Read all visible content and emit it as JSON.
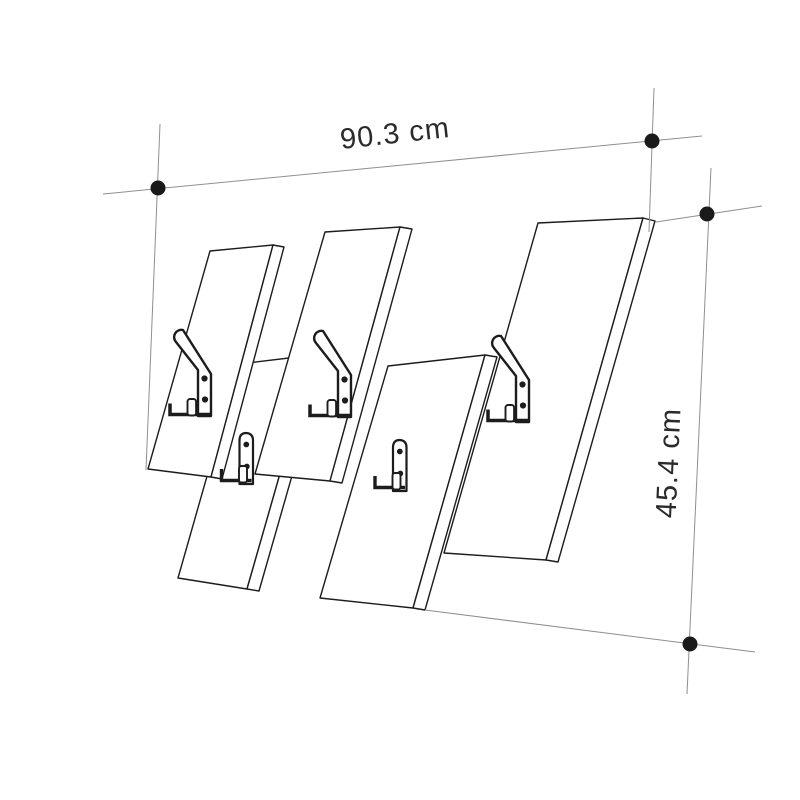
{
  "diagram": {
    "kind": "furniture-dimension-drawing",
    "subject": "wall-mounted coat rack with slanted slats and hooks",
    "view": "perspective line drawing",
    "slats": {
      "total": 5,
      "upper_row": 3,
      "lower_row": 2
    },
    "hooks": {
      "large_double_hooks": 3,
      "small_hooks": 2,
      "screw_holes_per_hook": 2
    },
    "dimensions": {
      "width": {
        "label": "90.3 cm",
        "value": 90.3,
        "unit": "cm"
      },
      "height": {
        "label": "45.4 cm",
        "value": 45.4,
        "unit": "cm"
      }
    },
    "dimension_markers": {
      "endpoint_dot_count": 4,
      "style": "thin crosshair lines with filled round endpoint dots"
    },
    "colors": {
      "line": "#1c1c1c",
      "dimension_line": "#8f8f8f",
      "dot": "#1a1a1a",
      "text": "#2a2a2a",
      "background": "#ffffff"
    }
  }
}
